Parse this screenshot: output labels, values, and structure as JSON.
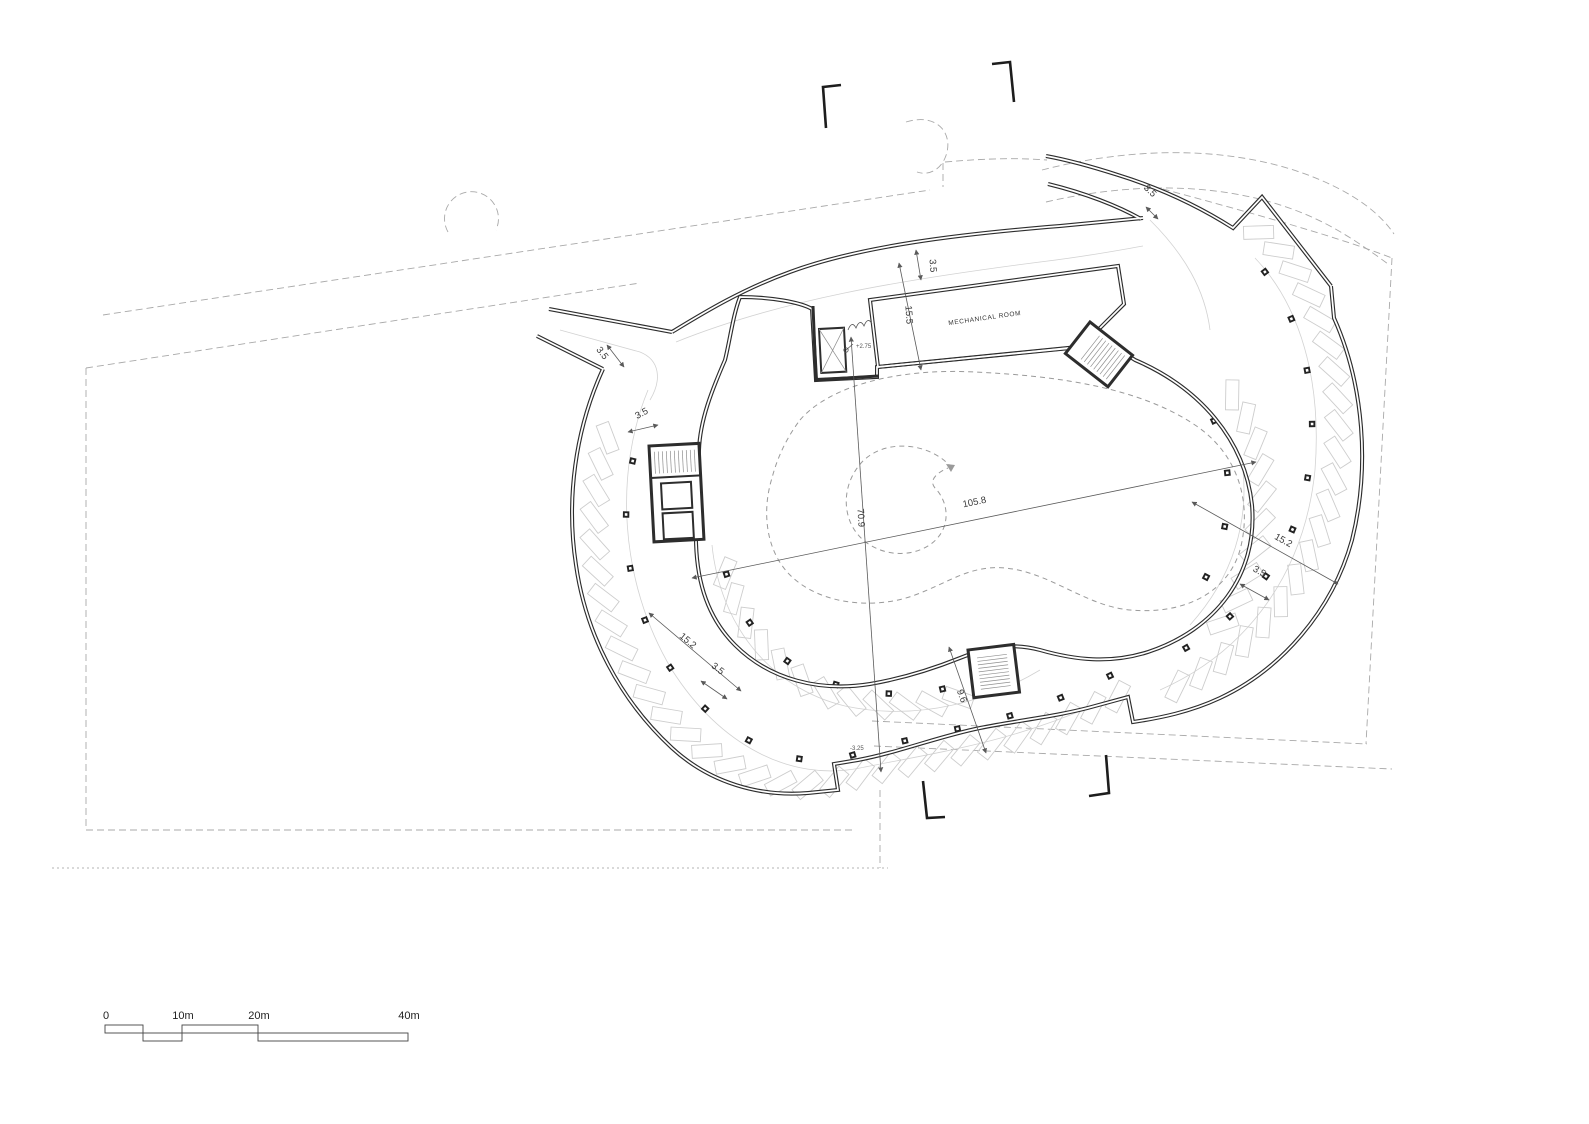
{
  "drawing": {
    "room_label": "MECHANICAL ROOM",
    "level_upper": "+2.75",
    "level_lower": "-3.25",
    "dims": {
      "top_lane": "3.5",
      "mech_depth": "15.5",
      "entry_lane": "3.5",
      "spur_lane": "3.5",
      "left_top_lane": "3.5",
      "court_length": "105.8",
      "court_width": "70.9",
      "right_band": "15.2",
      "right_lane": "3.5",
      "left_band": "15.2",
      "left_lane": "3.5",
      "bottom_band": "9.6"
    },
    "scalebar": {
      "t0": "0",
      "t10": "10m",
      "t20": "20m",
      "t40": "40m"
    },
    "colors": {
      "wall": "#2d2d2d",
      "stall": "#cdcdcd",
      "dashed": "#a9a9a9",
      "dim": "#5a5a5a"
    }
  }
}
